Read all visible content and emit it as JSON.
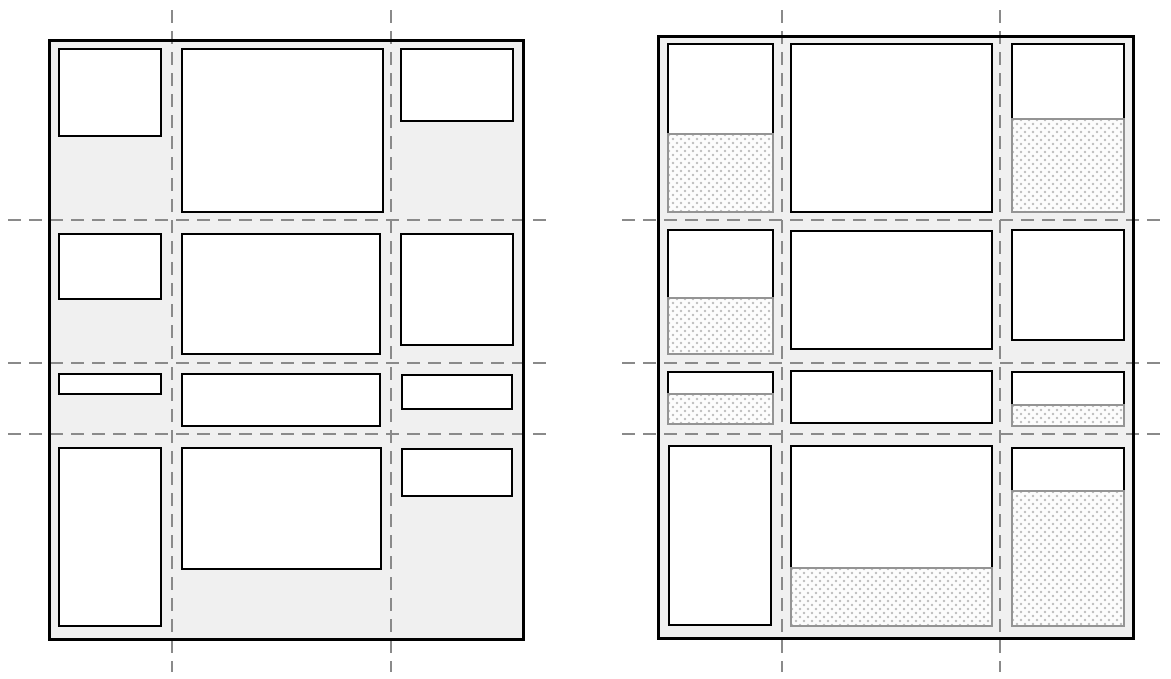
{
  "canvas": {
    "width": 1171,
    "height": 679,
    "background": "#ffffff"
  },
  "colors": {
    "container_fill": "#f0f0f0",
    "container_border": "#000000",
    "item_fill": "#ffffff",
    "item_border": "#000000",
    "track_line": "#8a8a8a",
    "ghost_border": "#949494",
    "ghost_fill": "#fcfcfc",
    "ghost_dot": "#bfbfbf"
  },
  "track_line_style": {
    "thickness": 2.4,
    "dash": 13,
    "gap": 8
  },
  "panels": [
    {
      "id": "left-grid",
      "container": {
        "x": 48,
        "y": 39,
        "w": 477,
        "h": 602
      },
      "column_lines": [
        {
          "x": 172,
          "y1": 10,
          "y2": 672
        },
        {
          "x": 391,
          "y1": 10,
          "y2": 672
        }
      ],
      "row_lines": [
        {
          "y": 220,
          "x1": 8,
          "x2": 546
        },
        {
          "y": 363,
          "x1": 8,
          "x2": 546
        },
        {
          "y": 434,
          "x1": 8,
          "x2": 546
        }
      ],
      "items": [
        {
          "x": 58,
          "y": 48,
          "w": 104,
          "h": 89,
          "ghost_h": 0
        },
        {
          "x": 181,
          "y": 48,
          "w": 203,
          "h": 165,
          "ghost_h": 0
        },
        {
          "x": 400,
          "y": 48,
          "w": 114,
          "h": 74,
          "ghost_h": 0
        },
        {
          "x": 58,
          "y": 233,
          "w": 104,
          "h": 67,
          "ghost_h": 0
        },
        {
          "x": 181,
          "y": 233,
          "w": 200,
          "h": 122,
          "ghost_h": 0
        },
        {
          "x": 400,
          "y": 233,
          "w": 114,
          "h": 113,
          "ghost_h": 0
        },
        {
          "x": 58,
          "y": 373,
          "w": 104,
          "h": 22,
          "ghost_h": 0
        },
        {
          "x": 181,
          "y": 373,
          "w": 200,
          "h": 54,
          "ghost_h": 0
        },
        {
          "x": 401,
          "y": 374,
          "w": 112,
          "h": 36,
          "ghost_h": 0
        },
        {
          "x": 58,
          "y": 447,
          "w": 104,
          "h": 180,
          "ghost_h": 0
        },
        {
          "x": 181,
          "y": 447,
          "w": 201,
          "h": 123,
          "ghost_h": 0
        },
        {
          "x": 401,
          "y": 448,
          "w": 112,
          "h": 49,
          "ghost_h": 0
        }
      ]
    },
    {
      "id": "right-grid",
      "container": {
        "x": 657,
        "y": 35,
        "w": 478,
        "h": 605
      },
      "column_lines": [
        {
          "x": 782,
          "y1": 10,
          "y2": 672
        },
        {
          "x": 1000,
          "y1": 10,
          "y2": 672
        }
      ],
      "row_lines": [
        {
          "y": 220,
          "x1": 622,
          "x2": 1162
        },
        {
          "y": 363,
          "x1": 622,
          "x2": 1162
        },
        {
          "y": 434,
          "x1": 622,
          "x2": 1162
        }
      ],
      "items": [
        {
          "x": 667,
          "y": 43,
          "w": 107,
          "h": 90,
          "ghost_h": 80
        },
        {
          "x": 790,
          "y": 43,
          "w": 203,
          "h": 170,
          "ghost_h": 0
        },
        {
          "x": 1011,
          "y": 43,
          "w": 114,
          "h": 75,
          "ghost_h": 95
        },
        {
          "x": 667,
          "y": 229,
          "w": 107,
          "h": 68,
          "ghost_h": 58
        },
        {
          "x": 790,
          "y": 230,
          "w": 203,
          "h": 120,
          "ghost_h": 0
        },
        {
          "x": 1011,
          "y": 229,
          "w": 114,
          "h": 112,
          "ghost_h": 0
        },
        {
          "x": 667,
          "y": 371,
          "w": 107,
          "h": 22,
          "ghost_h": 32
        },
        {
          "x": 790,
          "y": 370,
          "w": 203,
          "h": 54,
          "ghost_h": 0
        },
        {
          "x": 1011,
          "y": 371,
          "w": 114,
          "h": 33,
          "ghost_h": 23
        },
        {
          "x": 668,
          "y": 445,
          "w": 104,
          "h": 181,
          "ghost_h": 0
        },
        {
          "x": 790,
          "y": 445,
          "w": 203,
          "h": 122,
          "ghost_h": 60
        },
        {
          "x": 1011,
          "y": 447,
          "w": 114,
          "h": 43,
          "ghost_h": 137
        }
      ]
    }
  ]
}
